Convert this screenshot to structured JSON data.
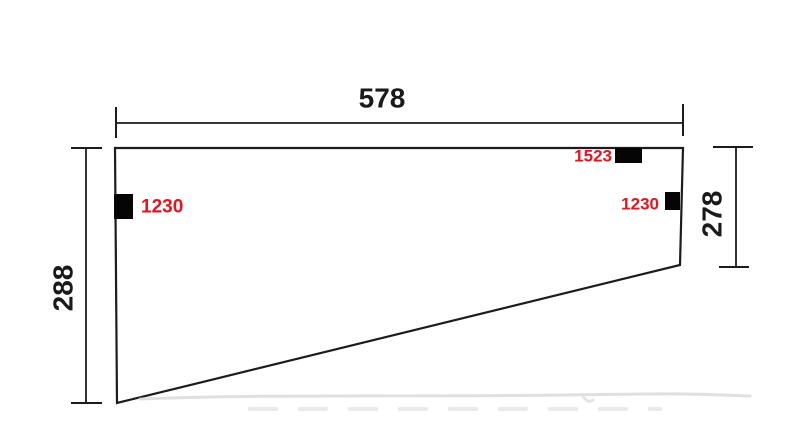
{
  "diagram": {
    "kind": "panel-dimension-drawing",
    "dimensions": {
      "top": {
        "value": "578",
        "orientation": "horizontal"
      },
      "left": {
        "value": "288",
        "orientation": "vertical"
      },
      "right": {
        "value": "278",
        "orientation": "vertical"
      }
    },
    "markers": {
      "left": {
        "label": "1230"
      },
      "top_right": {
        "label": "1523"
      },
      "right": {
        "label": "1230"
      }
    }
  },
  "colors": {
    "line": "#1c1c1c",
    "dim_text": "#1a1a1a",
    "label_red": "#e8131d",
    "marker_black": "#050505",
    "background": "#ffffff"
  }
}
